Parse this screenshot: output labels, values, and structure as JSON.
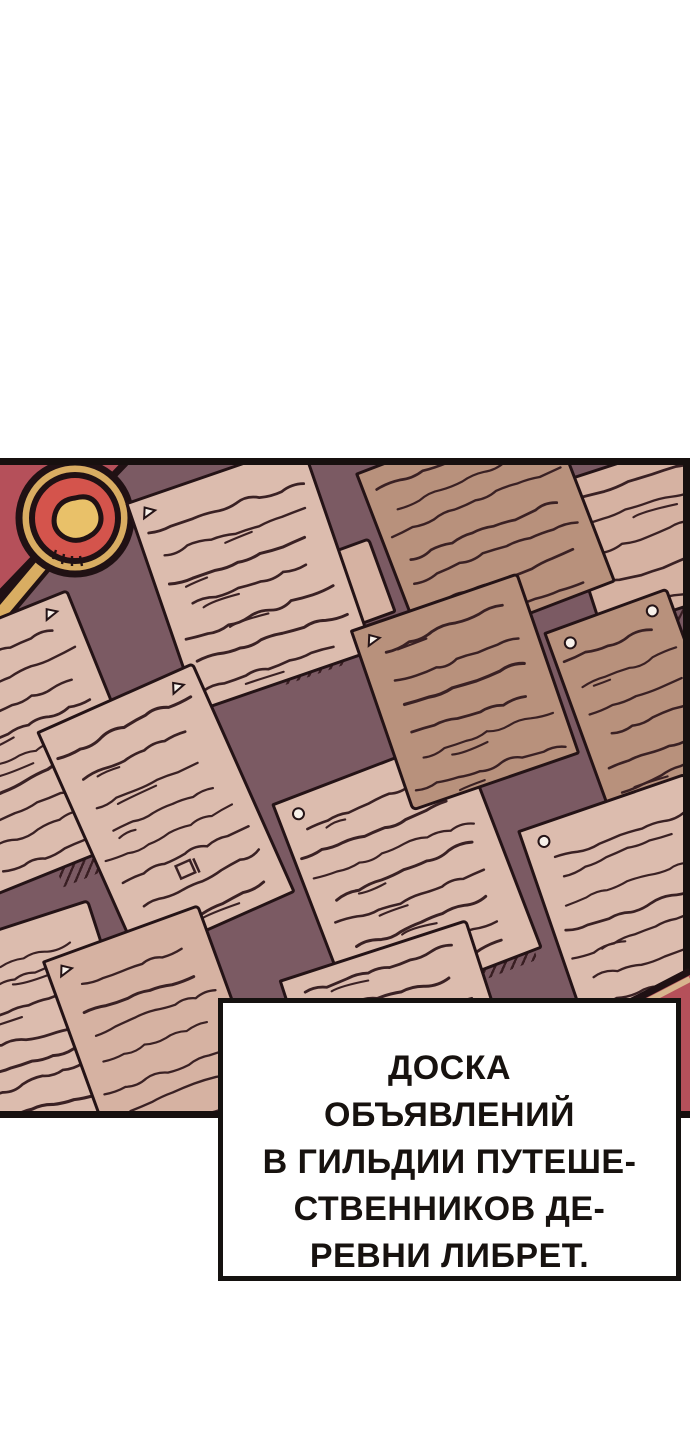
{
  "scene": {
    "type": "webtoon-comic-panel",
    "description": "Bulletin board covered with pinned handwritten notes; red board frame with gold ring ornament in the top-left corner",
    "objects": [
      {
        "name": "bulletin-board-panel"
      },
      {
        "name": "red-frame-corner"
      },
      {
        "name": "gold-ring-pin-ornament"
      },
      {
        "name": "pinned-notes",
        "count": 13
      },
      {
        "name": "red-frame-bottom-right"
      }
    ]
  },
  "caption": {
    "text": "ДОСКА\nОБЪЯВЛЕНИЙ\nВ ГИЛЬДИИ ПУТЕШЕ-\nСТВЕННИКОВ ДЕ-\nРЕВНИ ЛИБРЕТ."
  },
  "colors": {
    "background": "#ffffff",
    "board": "#7b5a63",
    "paper_light": "#dcbcae",
    "paper_light_alt": "#d6b2a2",
    "paper_tan": "#b8917c",
    "outline_ink": "#241316",
    "scribble_ink": "#3a2124",
    "frame_red": "#b5505a",
    "ring_red": "#d4544c",
    "gold": "#d9ad62",
    "gold_light": "#e9c169",
    "pin_white": "#f7f1ea",
    "caption_text": "#17120f",
    "panel_border": "#17100f"
  }
}
